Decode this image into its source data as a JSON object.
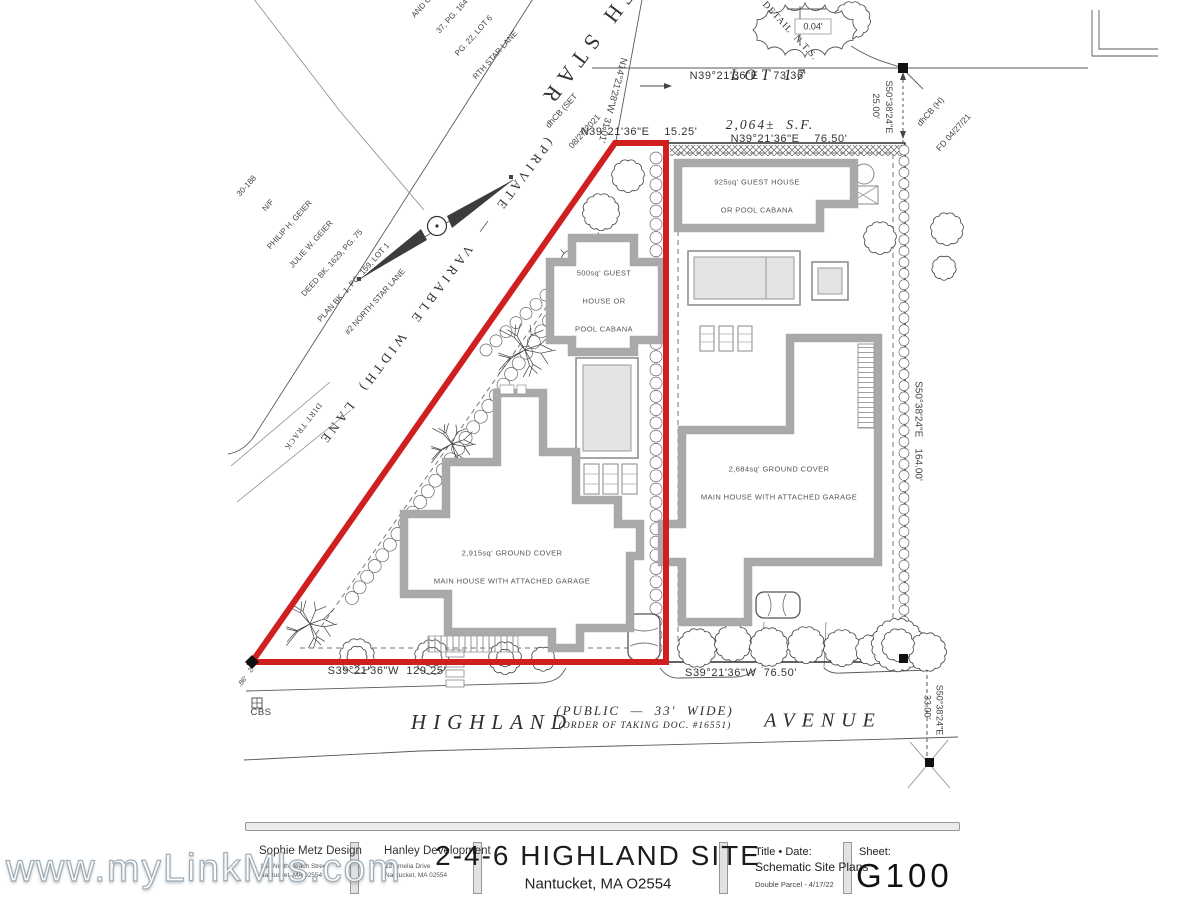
{
  "watermark": "www.myLinkMls.com",
  "colors": {
    "parcel_outline_red": "#cf1f1f"
  },
  "title_block": {
    "designer_name": "Sophie Metz Design",
    "designer_addr1": "15A North Beach Street",
    "designer_addr2": "Nantucket, MA 02554",
    "developer_name": "Hanley Development",
    "developer_addr1": "12 Amelia Drive",
    "developer_addr2": "Nantucket, MA 02554",
    "project_title": "2-4-6 HIGHLAND SITE",
    "project_location": "Nantucket, MA O2554",
    "title_date_label": "Title • Date:",
    "title_date_line1": "Schematic Site Plans",
    "title_date_line2": "Double Parcel - 4/17/22",
    "sheet_label": "Sheet:",
    "sheet_number": "G100"
  },
  "plan": {
    "streets": {
      "north_star": "NORTH STAR",
      "lane": "(PRIVATE  —  VARIABLE  WIDTH)  LANE",
      "dirt_track": "DIRT TRACK",
      "highland": "HIGHLAND",
      "highland_width": "(PUBLIC  —  33'  WIDE)",
      "highland_taking": "(ORDER OF TAKING DOC. #16551)",
      "avenue": "AVENUE"
    },
    "lot17_name": "LOT 17",
    "lot17_area": "2,064±  S.F.",
    "bearing_top": "N39°21'36\"E    73.36'",
    "bearing_apex": "N39°21'36\"E    15.25'",
    "bearing_top_right": "N39°21'36\"E    76.50'",
    "bearing_bottom_left": "S39°21'36\"W  129.25'",
    "bearing_bottom_right": "S39°21'36\"W  76.50'",
    "bearing_lane": "N14°21'28\"W  31.01'",
    "bearing_right_upper": "S50°38'24\"E",
    "dist_right_upper": "25.00'",
    "bearing_right_mid": "S50°38'24\"E    164.00'",
    "bearing_right_lower": "S50°38'24\"E",
    "dist_right_lower": "33.00'",
    "monument_set_line1": "dhCB (SET",
    "monument_set_line2": "08/27/2021",
    "monument_found_line1": "dhCB (H)",
    "monument_found_line2": "FD 04/27/21",
    "monument_cbs": "CBS",
    "corner_note1": "2.",
    "corner_note2": ".86'",
    "detail_label": "DETAIL  N.T.S.",
    "detail_dim": "0.04'",
    "neighbor_upper": [
      "AND CO., LLC",
      "37, PG. 164",
      "PG. 22, LOT 6",
      "RTH STAR LANE"
    ],
    "neighbor_west": [
      "30-188",
      "N/F",
      "PHILIP H. GEIER",
      "JULIE W. GEIER",
      "DEED BK. 1629, PG. 75",
      "PLAN BK. 1, PG. 159, LOT 1",
      "#2 NORTH STAR LANE"
    ],
    "bldg_guest_left": [
      "500sq' GUEST",
      "HOUSE OR",
      "POOL CABANA"
    ],
    "bldg_guest_right": [
      "925sq' GUEST HOUSE",
      "OR POOL CABANA"
    ],
    "bldg_main_left": [
      "2,915sq' GROUND COVER",
      "MAIN HOUSE WITH ATTACHED GARAGE"
    ],
    "bldg_main_right": [
      "2,684sq' GROUND COVER",
      "MAIN HOUSE WITH ATTACHED GARAGE"
    ]
  }
}
